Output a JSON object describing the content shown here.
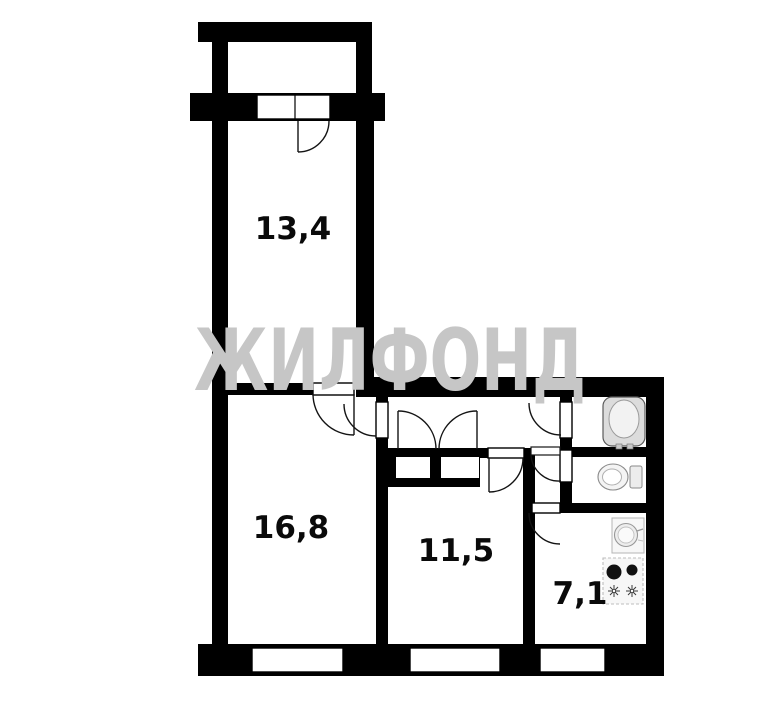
{
  "watermark": "ЖИЛФОНД",
  "rooms": [
    {
      "area": "13,4"
    },
    {
      "area": "16,8"
    },
    {
      "area": "11,5"
    },
    {
      "area": "7,1"
    }
  ],
  "fixtures": [
    "bathtub",
    "toilet",
    "sink",
    "stove"
  ],
  "colors": {
    "walls": "#000000",
    "background": "#ffffff",
    "watermark": "#c6c6c6",
    "label": "#0a0a0a"
  }
}
